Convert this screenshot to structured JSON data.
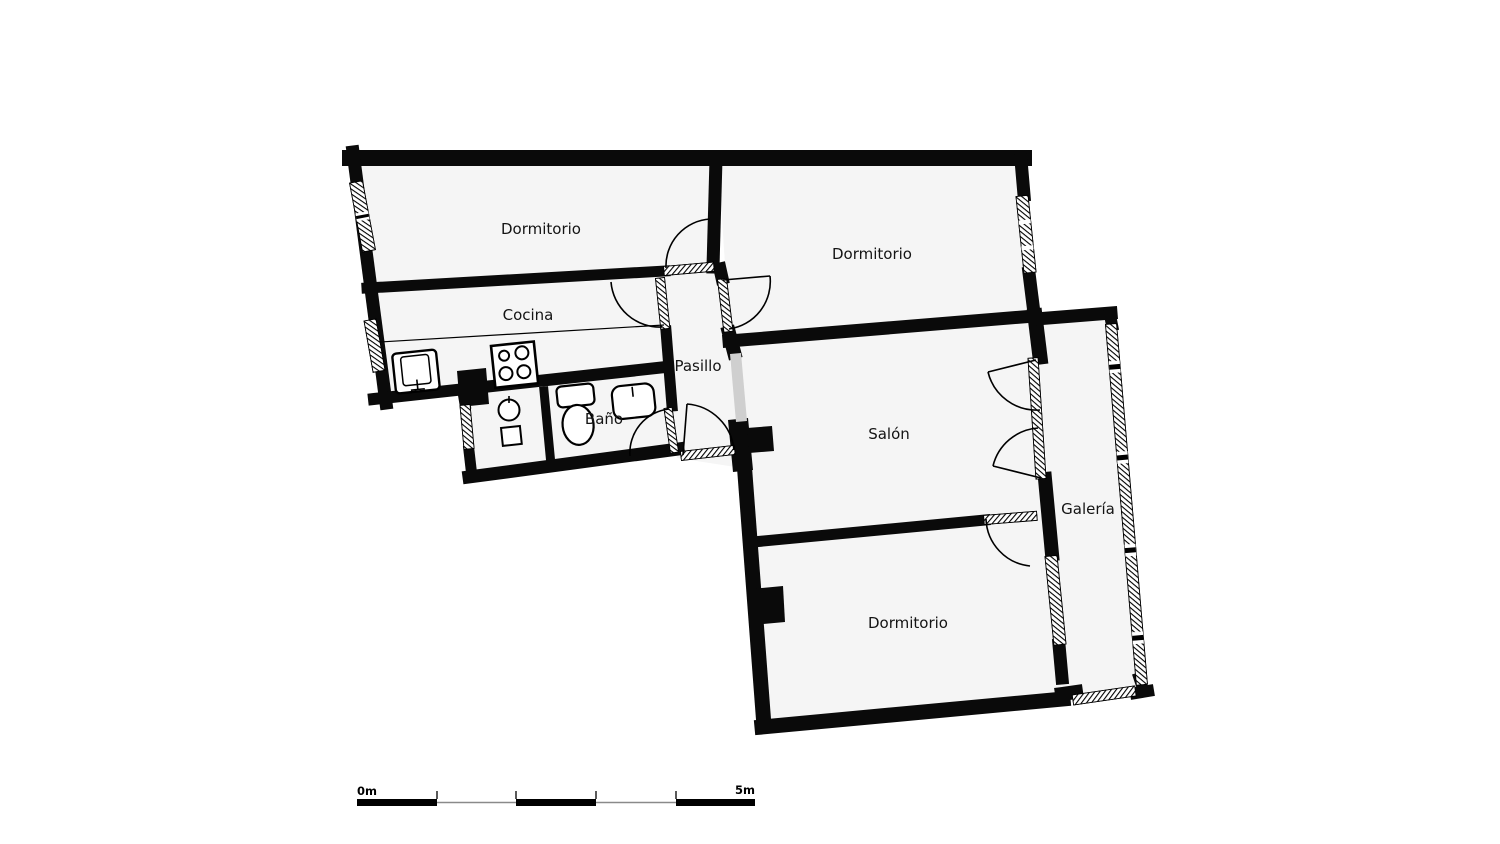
{
  "plan": {
    "rooms": {
      "dormitorio_top_left": {
        "label": "Dormitorio"
      },
      "dormitorio_top_right": {
        "label": "Dormitorio"
      },
      "cocina": {
        "label": "Cocina"
      },
      "pasillo": {
        "label": "Pasillo"
      },
      "bano": {
        "label": "Baño"
      },
      "salon": {
        "label": "Salón"
      },
      "galeria": {
        "label": "Galería"
      },
      "dormitorio_bottom": {
        "label": "Dormitorio"
      }
    },
    "fixtures": [
      "kitchen-sink",
      "stove",
      "laundry-basin",
      "toilet",
      "bidet"
    ],
    "colors": {
      "wall": "#0a0a0a",
      "room_fill": "#f5f5f5",
      "background": "#ffffff",
      "opening": "#cfcfcf",
      "scale_line": "#8a8a8a",
      "label_text": "#141414"
    }
  },
  "scale_bar": {
    "start_label": "0m",
    "end_label": "5m"
  }
}
